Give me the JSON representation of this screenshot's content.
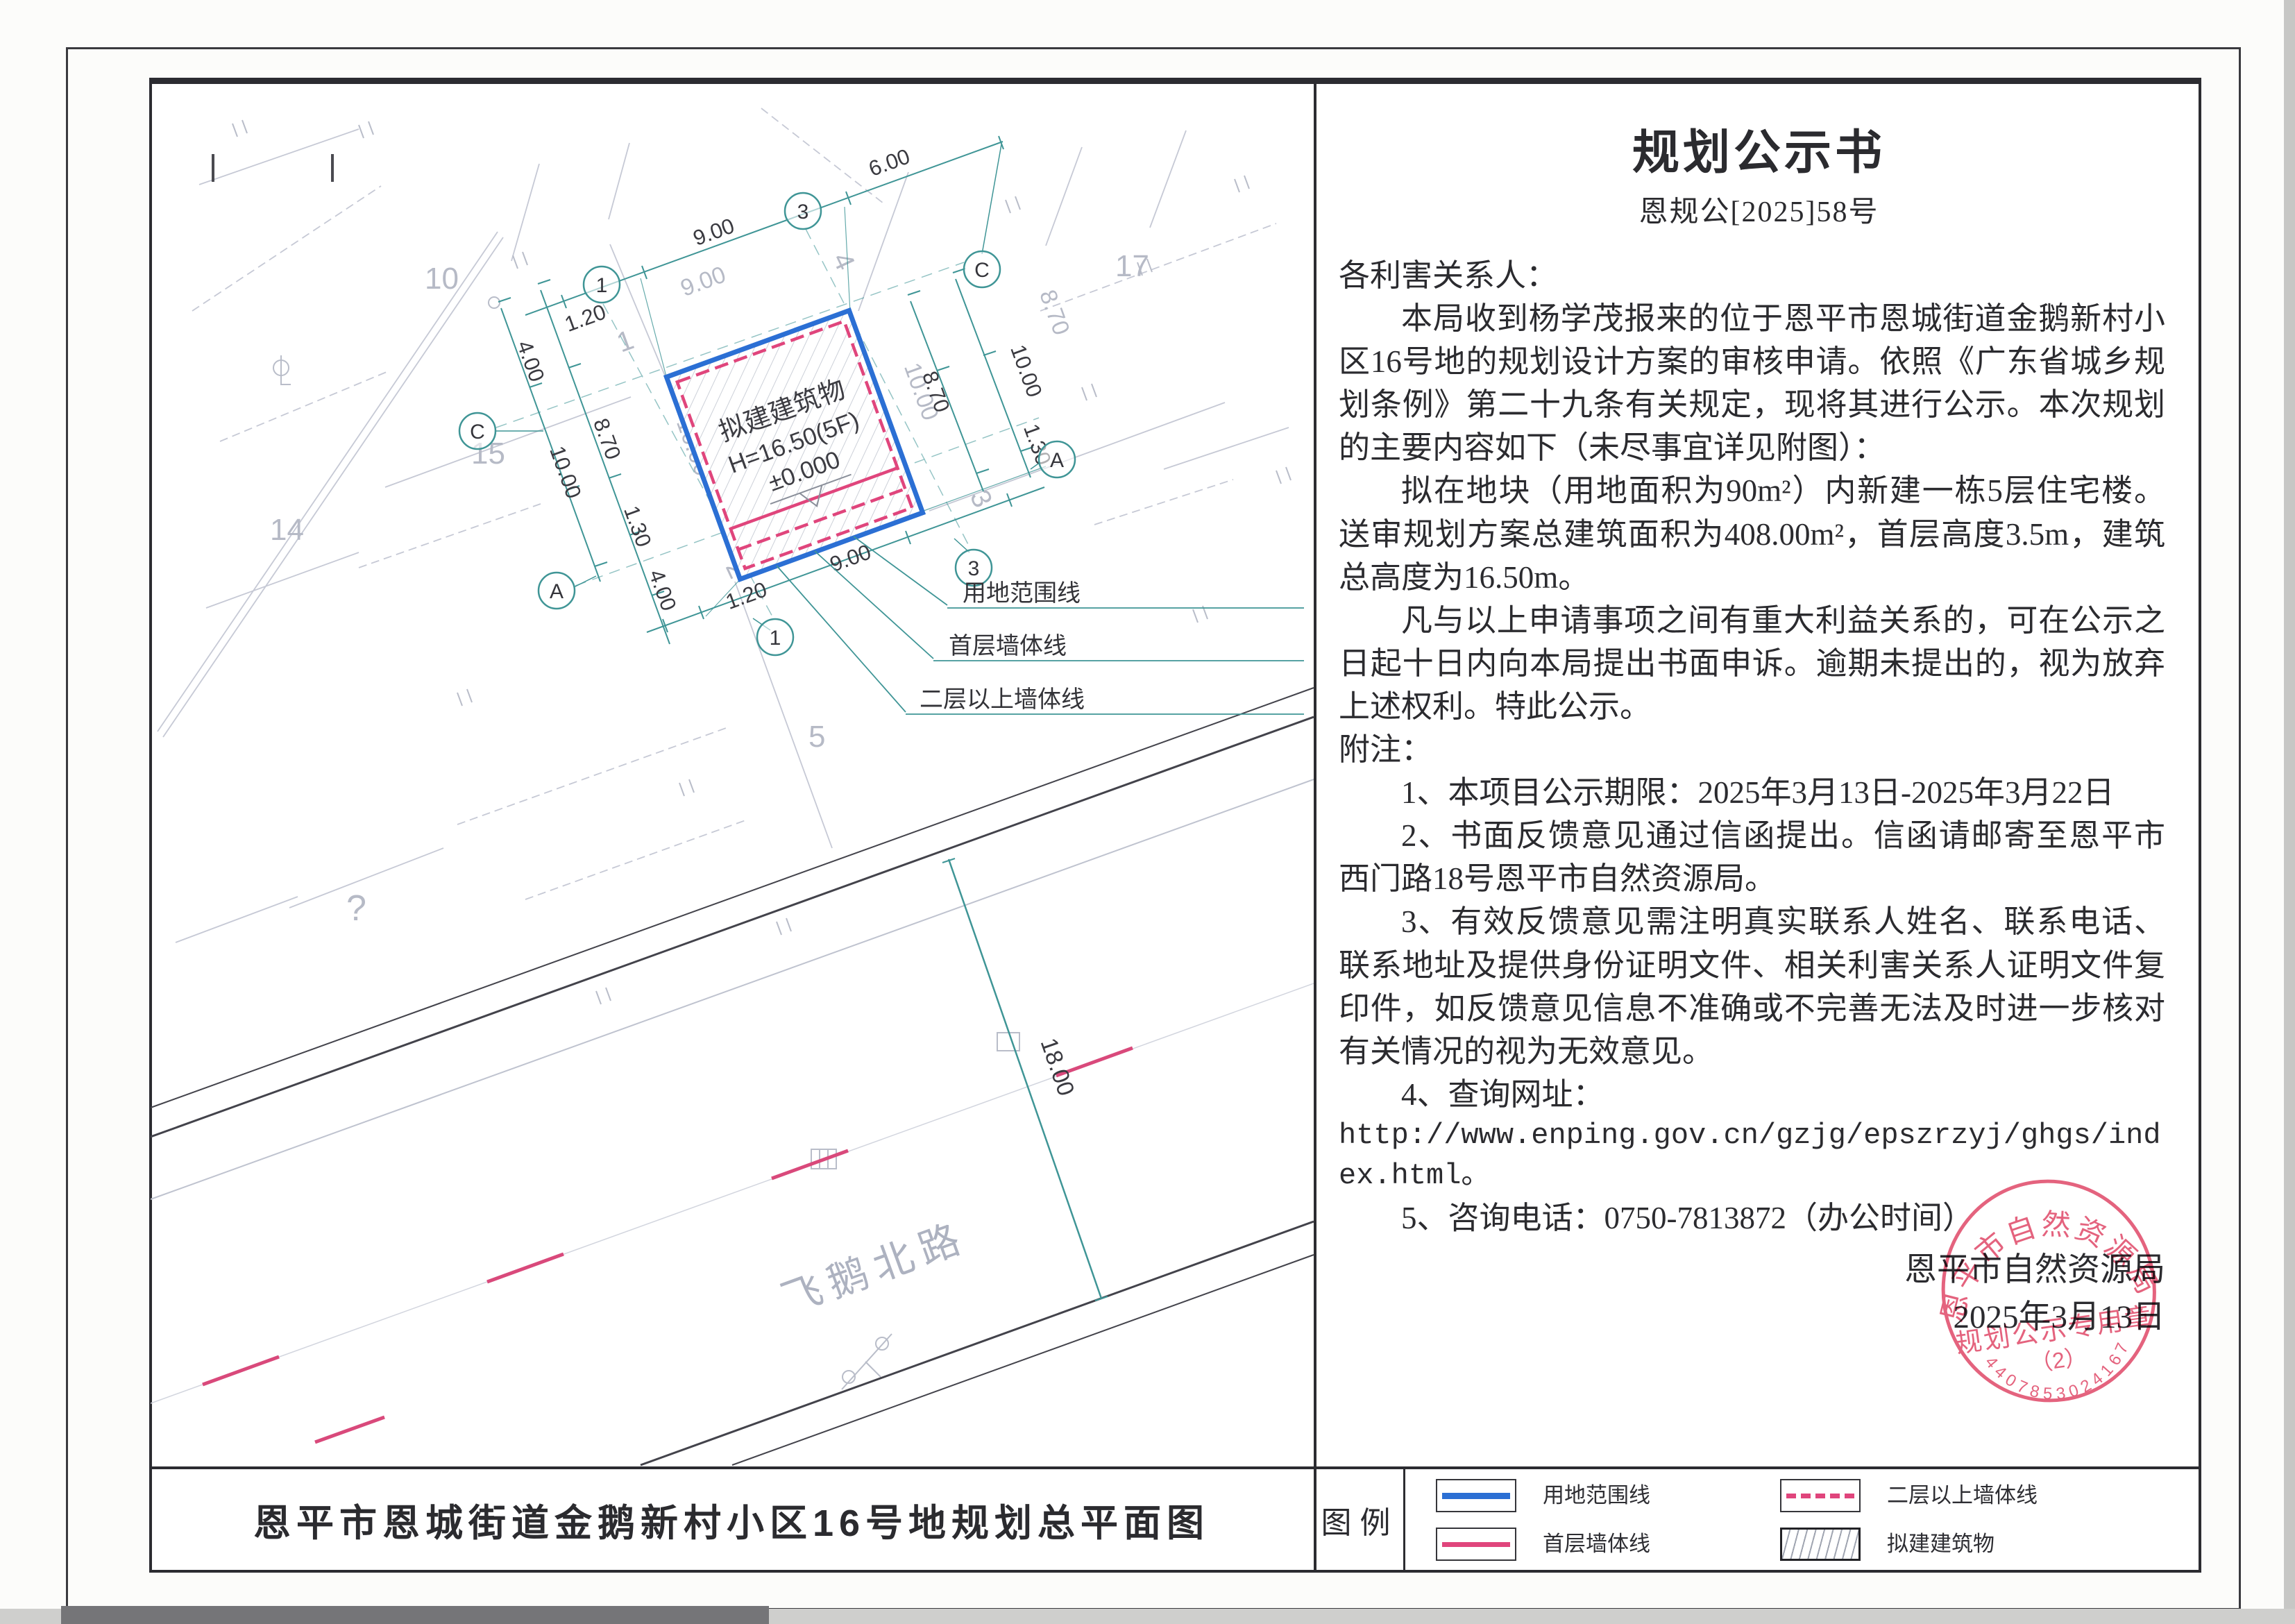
{
  "notice": {
    "title": "规划公示书",
    "doc_no": "恩规公[2025]58号",
    "salutation": "各利害关系人：",
    "para1": "本局收到杨学茂报来的位于恩平市恩城街道金鹅新村小区16号地的规划设计方案的审核申请。依照《广东省城乡规划条例》第二十九条有关规定，现将其进行公示。本次规划的主要内容如下（未尽事宜详见附图）：",
    "para2": "拟在地块（用地面积为90m²）内新建一栋5层住宅楼。送审规划方案总建筑面积为408.00m²，首层高度3.5m，建筑总高度为16.50m。",
    "para3": "凡与以上申请事项之间有重大利益关系的，可在公示之日起十日内向本局提出书面申诉。逾期未提出的，视为放弃上述权利。特此公示。",
    "notes_label": "附注：",
    "notes": [
      "1、本项目公示期限：2025年3月13日-2025年3月22日",
      "2、书面反馈意见通过信函提出。信函请邮寄至恩平市西门路18号恩平市自然资源局。",
      "3、有效反馈意见需注明真实联系人姓名、联系电话、联系地址及提供身份证明文件、相关利害关系人证明文件复印件，如反馈意见信息不准确或不完善无法及时进一步核对有关情况的视为无效意见。",
      "4、查询网址：",
      "http://www.enping.gov.cn/gzjg/epszrzyj/ghgs/index.html。",
      "5、咨询电话：0750-7813872（办公时间）"
    ]
  },
  "sign": {
    "issuer": "恩平市自然资源局",
    "date": "2025年3月13日"
  },
  "stamp": {
    "arc_text": "恩平市自然资源局",
    "band_text": "规划公示专用章",
    "sub_text": "（2）",
    "serial": "4407853024167"
  },
  "plan": {
    "building": {
      "label": "拟建建筑物",
      "height": "H=16.50(5F)",
      "level": "±0.000"
    },
    "road": {
      "name": "飞鹅北路",
      "width_label": "18.00"
    },
    "callouts": [
      "用地范围线",
      "首层墙体线",
      "二层以上墙体线"
    ],
    "dims": {
      "v600": "6.00",
      "v900": "9.00",
      "v870": "8.70",
      "v1000": "10.00",
      "v120": "1.20",
      "v130": "1.30",
      "v400": "4.00"
    },
    "axis": {
      "a": "A",
      "c": "C",
      "one": "1",
      "three": "3"
    },
    "parcels": {
      "p1": "1",
      "p2": "2",
      "p3": "3",
      "p4": "4",
      "p5": "5",
      "p10": "10",
      "p14": "14",
      "p15": "15",
      "p17": "17",
      "pq": "?"
    }
  },
  "footer": {
    "plan_title": "恩平市恩城街道金鹅新村小区16号地规划总平面图",
    "legend_label": "图例",
    "legend": [
      {
        "label": "用地范围线"
      },
      {
        "label": "首层墙体线"
      },
      {
        "label": "二层以上墙体线"
      },
      {
        "label": "拟建建筑物"
      }
    ]
  },
  "colors": {
    "boundary_blue": "#2b6fd4",
    "wall_pink": "#e0457c",
    "dim_teal": "#3f9596",
    "stamp_red": "#e25673"
  }
}
